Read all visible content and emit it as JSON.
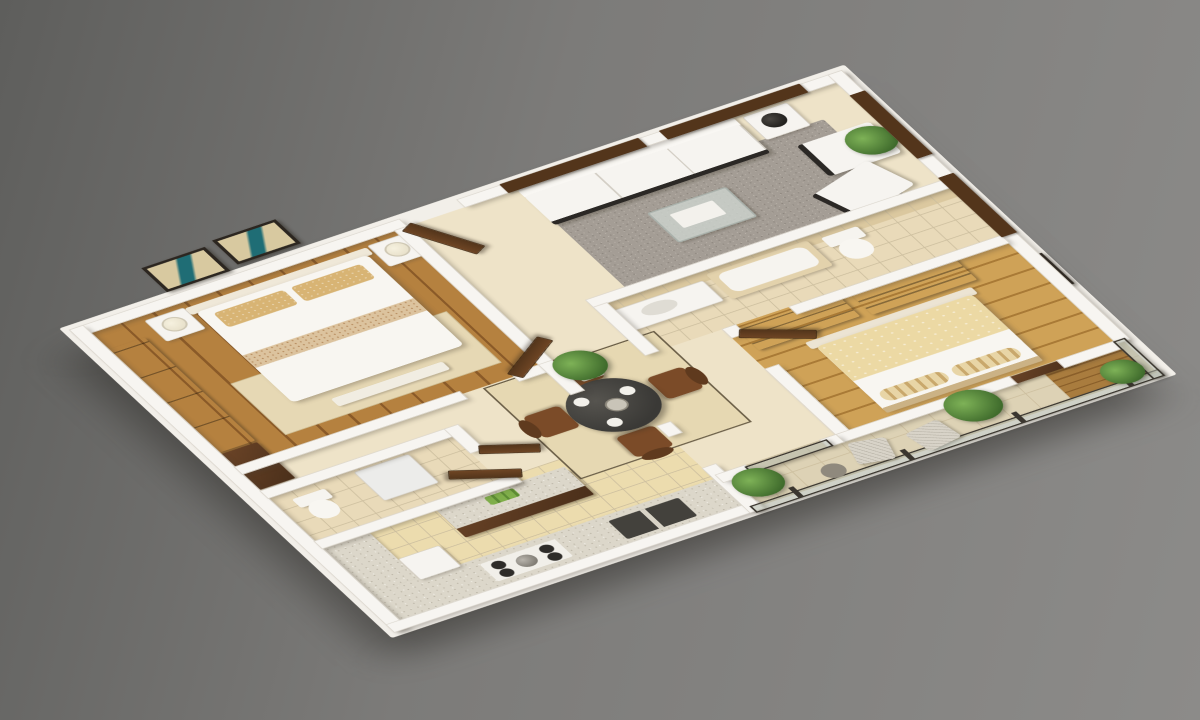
{
  "scene": {
    "type": "3d-floor-plan-render",
    "view": "isometric aerial cutaway",
    "subject": "two-bedroom apartment with balcony",
    "background": "plain gray studio backdrop",
    "visible_text": "none"
  },
  "palette": {
    "bg_dark": "#5e5e5c",
    "bg_mid": "#7c7b79",
    "bg_light": "#8c8b89",
    "wall": "#f7f5f1",
    "wall_edge": "#ddd8cf",
    "floor_beige": "#eee3c8",
    "floor_kitchen": "#ecdcae",
    "floor_bath": "#e9dab9",
    "floor_balcony": "#ddd2b5",
    "tile_line": "#cdbf9f",
    "wood1a": "#b5813f",
    "wood1b": "#8a5a28",
    "wood2a": "#cfa257",
    "wood2b": "#a97a36",
    "deck_a": "#a97c3e",
    "deck_b": "#8a5f2a",
    "wood_dark": "#4a2f1a",
    "wood_dark_l": "#6b4427",
    "door_a": "#6e4524",
    "door_b": "#53351b",
    "granite": "#dcd7ca",
    "granite_dot": "#b9b3a4",
    "granite_dot2": "#efece4",
    "rug_gray": "#a49d95",
    "rug_gray_d": "#8d867e",
    "rug_gray_l": "#c3bcb2",
    "rug_dining": "#e6d8b2",
    "rug_dining_border": "#6b5f48",
    "rug_bed": "#e6d8b4",
    "furn_white": "#f6f4f0",
    "sofa_base": "#2b2825",
    "bed_white": "#f8f6f1",
    "blanket_cream": "#ecd9a4",
    "pillow_tan": "#d8b474",
    "chair_brown": "#7b4b28",
    "chair_brown_d": "#5f3a1e",
    "table_dark": "#3a3936",
    "rail": "#3b362f",
    "wire": "#d8d3c8",
    "leaf_l": "#7eb257",
    "leaf_d": "#3f6b2c",
    "frame": "#2c2620",
    "art_bg": "#d8c9a0",
    "art_teal": "#1f6d75",
    "lamp_shade": "#e9e2cc",
    "lamp_black": "#23211e"
  },
  "rooms": [
    {
      "name": "bedroom-1",
      "floor": "medium oak plank",
      "position": "top-left"
    },
    {
      "name": "entry-foyer",
      "floor": "beige tile",
      "position": "top-center"
    },
    {
      "name": "living-room",
      "floor": "beige tile with gray shag rug",
      "position": "top-right"
    },
    {
      "name": "bathroom-main",
      "floor": "beige ceramic tile",
      "position": "center-right strip"
    },
    {
      "name": "master-bedroom",
      "floor": "light oak plank",
      "position": "right"
    },
    {
      "name": "dining-area",
      "floor": "beige tile with bordered rug",
      "position": "center"
    },
    {
      "name": "bathroom-small",
      "floor": "beige ceramic tile",
      "position": "center-left"
    },
    {
      "name": "kitchen",
      "floor": "warm beige tile",
      "position": "bottom-left"
    },
    {
      "name": "balcony",
      "floor": "stone tile with wood deck strip",
      "position": "bottom-right"
    }
  ],
  "furniture": {
    "bedroom_1": [
      "double bed with tan patterned pillows",
      "two white nightstands",
      "two table lamps",
      "dark wardrobe pair along left wall",
      "two framed artworks on back wall",
      "beige area rug"
    ],
    "living_room": [
      "white three-seat sofa with black base",
      "two white armchairs",
      "glass coffee table with tray",
      "white side table",
      "black shade table lamp",
      "potted plant",
      "gray shag rug"
    ],
    "bathroom_main": [
      "vanity sink counter",
      "bathtub with tiled surround",
      "toilet"
    ],
    "master_bedroom": [
      "double bed with cream duvet and striped bolsters",
      "two dark wood dressers",
      "wood bench at footboard niche",
      "framed artwork on right wall"
    ],
    "dining_area": [
      "round dark dining table with place settings",
      "four brown upholstered chairs",
      "square bordered rug"
    ],
    "bathroom_small": [
      "toilet",
      "white washer cabinet"
    ],
    "kitchen": [
      "L-shaped granite counter",
      "four-burner gas hob with kettle",
      "double-basin sink",
      "brown island cabinet with green bottles",
      "white appliance"
    ],
    "balcony": [
      "glass railing with dark frame",
      "three potted plants",
      "two wire mesh chairs",
      "small side table"
    ]
  },
  "openings": {
    "doors": [
      "entry-door",
      "bedroom-1-door",
      "small-bath-door",
      "kitchen-door",
      "master-bedroom-door"
    ],
    "door_finish": "dark walnut, shown open",
    "windows": [
      "living-back-window-1",
      "living-back-window-2",
      "right-wall-window-1",
      "right-wall-window-2"
    ],
    "window_finish": "dark walnut frame, gray glazing"
  },
  "counts": {
    "wall_pictures_bedroom1": 2,
    "dining_chairs": 4,
    "balcony_plants": 3,
    "windows": 4,
    "open_doors": 5
  }
}
